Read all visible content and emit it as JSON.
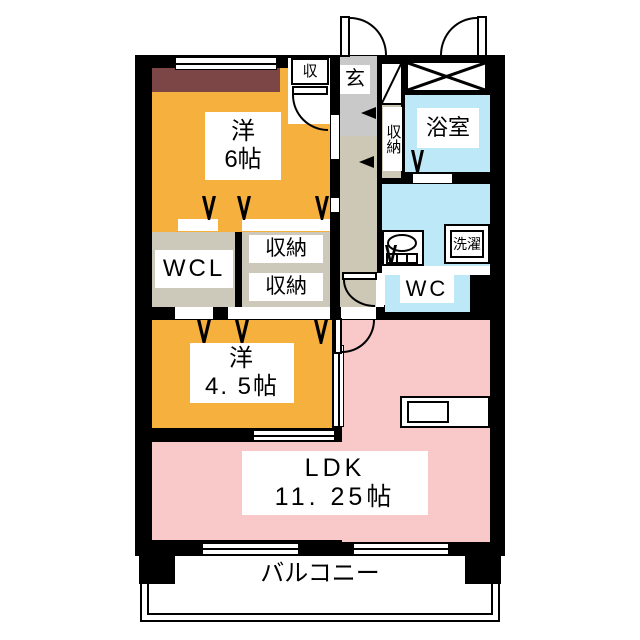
{
  "rooms": {
    "bedroom_6": {
      "label_line1": "洋",
      "label_line2": "6帖"
    },
    "bedroom_4_5": {
      "label_line1": "洋",
      "label_line2": "4. 5帖"
    },
    "ldk": {
      "label_line1": "LDK",
      "label_line2": "11. 25帖"
    },
    "walk_in_closet": {
      "label": "WCL"
    },
    "storage_upper": {
      "label": "収納"
    },
    "storage_lower": {
      "label": "収納"
    },
    "hall_storage": {
      "label": "収納"
    },
    "storage_small": {
      "label": "収"
    },
    "entrance": {
      "label": "玄"
    },
    "bathroom": {
      "label": "浴室"
    },
    "toilet": {
      "label": "WC"
    },
    "laundry": {
      "label": "洗濯"
    },
    "balcony": {
      "label": "バルコニー"
    }
  },
  "colors": {
    "wall": "#000000",
    "western_room": "#F5B03E",
    "ldk_pink": "#F9C9C9",
    "wet_area_blue": "#BCE8F7",
    "storage_gray": "#CCC9BB",
    "hallway_beige": "#CDC8B6",
    "entrance_gray": "#C9C9C9",
    "closet_maroon": "#7C4646"
  }
}
